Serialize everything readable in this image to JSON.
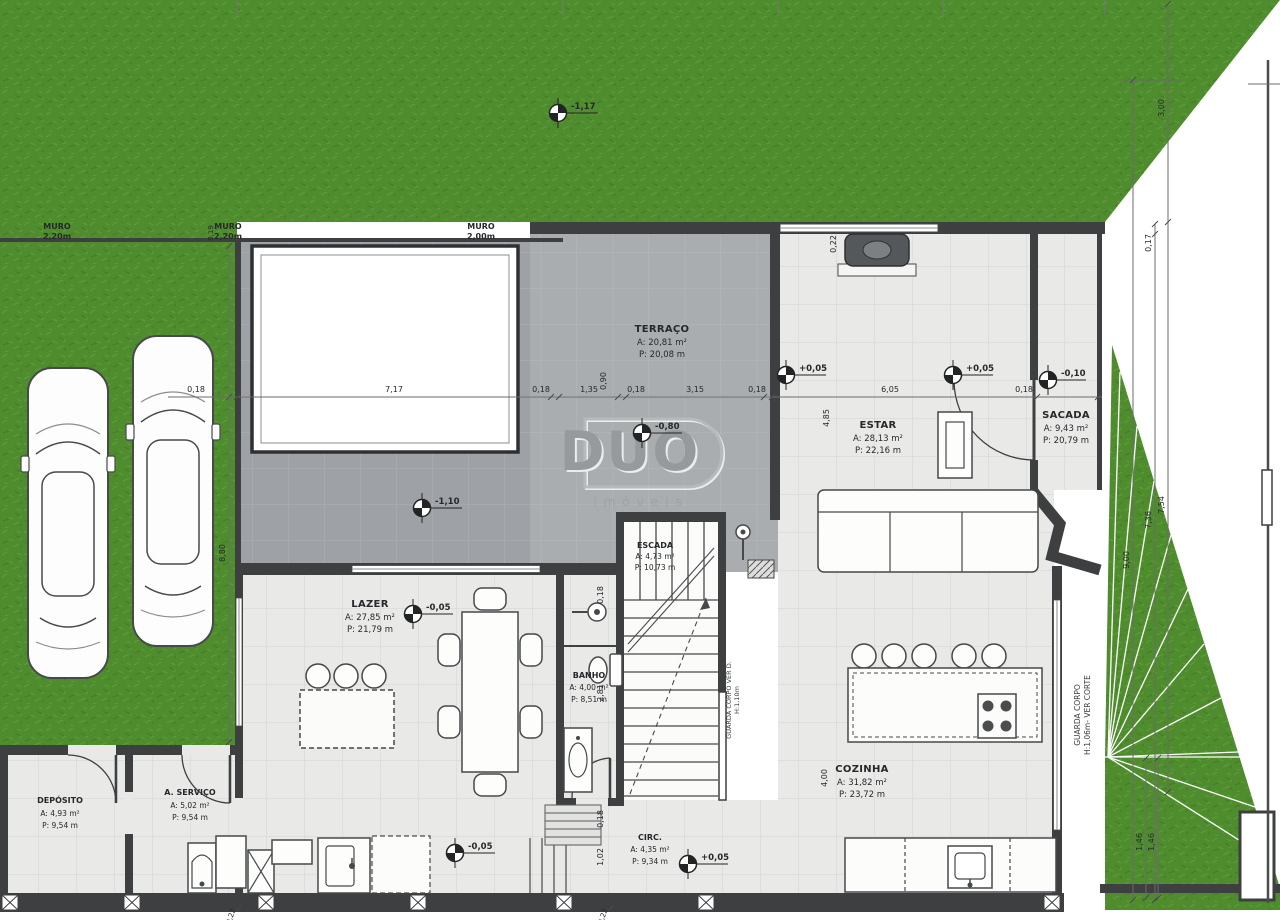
{
  "colors": {
    "grass": "#4f8c2e",
    "deck": "#9ea2a6",
    "terrace": "#aaadb0",
    "tile": "#e9e9e7",
    "wall": "#3d3f41"
  },
  "watermark": {
    "logo": "DUO",
    "subtitle": "imóveis"
  },
  "rooms": [
    {
      "id": "terraco",
      "name": "TERRAÇO",
      "area": "A: 20,81 m²",
      "perim": "P: 20,08 m"
    },
    {
      "id": "estar",
      "name": "ESTAR",
      "area": "A: 28,13 m²",
      "perim": "P: 22,16 m"
    },
    {
      "id": "sacada",
      "name": "SACADA",
      "area": "A: 9,43 m²",
      "perim": "P: 20,79 m"
    },
    {
      "id": "lazer",
      "name": "LAZER",
      "area": "A: 27,85 m²",
      "perim": "P: 21,79 m"
    },
    {
      "id": "escada",
      "name": "ESCADA",
      "area": "A: 4,73 m²",
      "perim": "P: 10,73 m"
    },
    {
      "id": "banho",
      "name": "BANHO",
      "area": "A: 4,00 m²",
      "perim": "P: 8,51 m"
    },
    {
      "id": "cozinha",
      "name": "COZINHA",
      "area": "A: 31,82 m²",
      "perim": "P: 23,72 m"
    },
    {
      "id": "circ",
      "name": "CIRC.",
      "area": "A: 4,35 m²",
      "perim": "P: 9,34 m"
    },
    {
      "id": "deposito",
      "name": "DEPÓSITO",
      "area": "A: 4,93 m²",
      "perim": "P: 9,54 m"
    },
    {
      "id": "servico",
      "name": "A. SERVIÇO",
      "area": "A: 5,02 m²",
      "perim": "P: 9,54 m"
    }
  ],
  "muro_labels": [
    {
      "name": "MURO",
      "spec": "2,20m"
    },
    {
      "name": "MURO",
      "spec": "2,20m"
    },
    {
      "name": "MURO",
      "spec": "2,00m"
    }
  ],
  "levels": [
    {
      "value": "-1,17"
    },
    {
      "value": "-1,10"
    },
    {
      "value": "-0,80"
    },
    {
      "value": "-0,05"
    },
    {
      "value": "+0,05"
    },
    {
      "value": "+0,05"
    },
    {
      "value": "-0,10"
    },
    {
      "value": "+0,05"
    },
    {
      "value": "-0,05"
    }
  ],
  "dims": {
    "horizontal": [
      "0,18",
      "7,17",
      "0,18",
      "1,35",
      "0,18",
      "3,15",
      "0,18",
      "6,05",
      "0,18"
    ],
    "vertical_right": [
      "3,00",
      "0,17",
      "9,00",
      "7,36",
      "7,54",
      "1,46",
      "1,46"
    ],
    "vertical_inner": [
      "0,90",
      "8,80",
      "0,22",
      "4,85",
      "4,00",
      "0,18",
      "2,81",
      "0,18",
      "1,02",
      "0,19",
      "0,22",
      "0,22"
    ]
  },
  "notes": {
    "guarda_corpo_kitchen_l1": "GUARDA CORPO",
    "guarda_corpo_kitchen_l2": "H:1,06m- VER CORTE",
    "guarda_corpo_stairs_l1": "GUARDA CORPO VER D.",
    "guarda_corpo_stairs_l2": "H:1,10m"
  }
}
